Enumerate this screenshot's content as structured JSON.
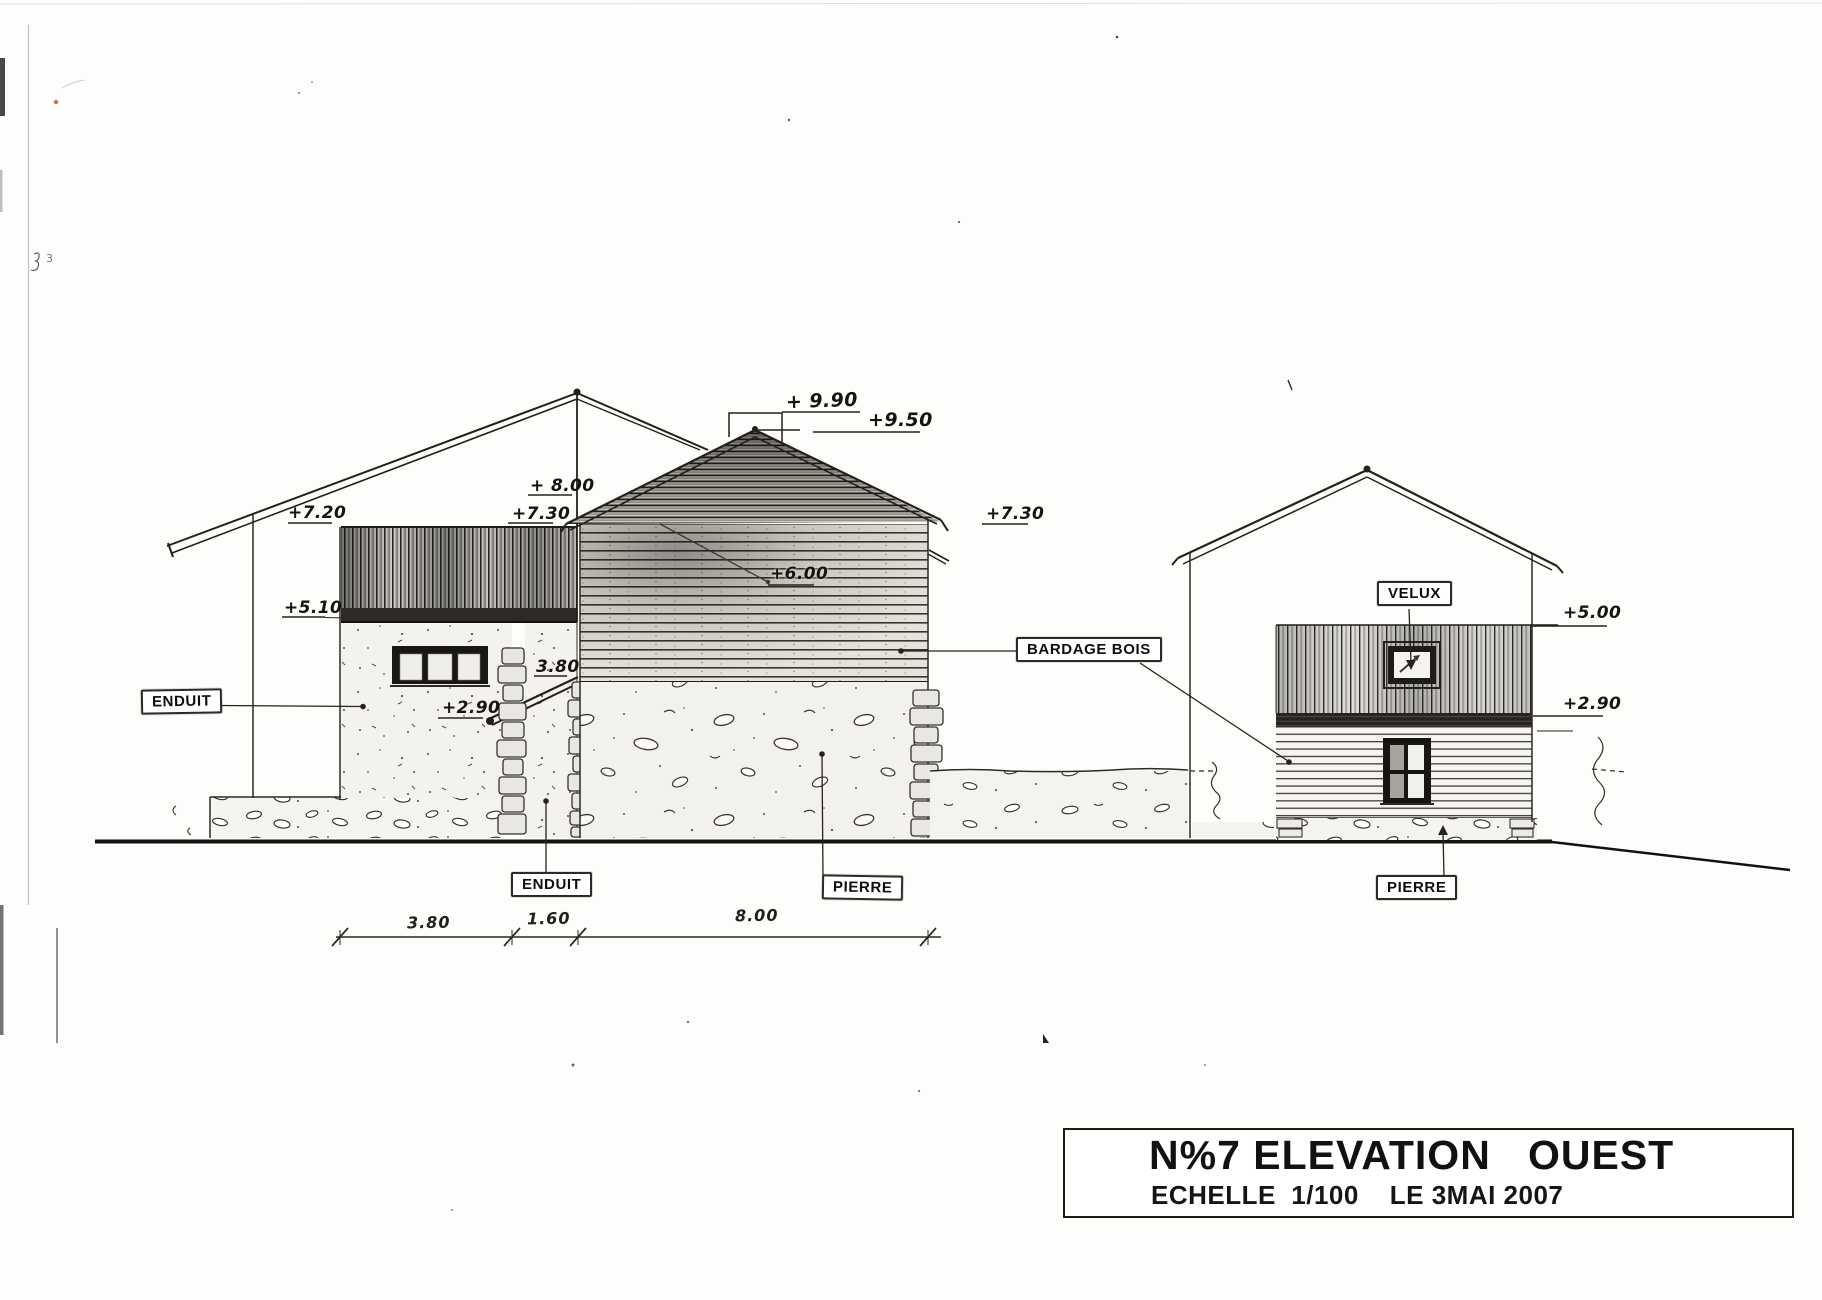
{
  "drawing": {
    "material_labels": {
      "enduit_left": "ENDUIT",
      "enduit_bottom": "ENDUIT",
      "pierre_center": "PIERRE",
      "pierre_right": "PIERRE",
      "bardage_bois": "BARDAGE  BOIS",
      "velux": "VELUX"
    },
    "elevation_marks": {
      "left_eave": "+7.20",
      "center_eave": "+ 8.00",
      "center_left_730": "+7.30",
      "left_band_bottom": "+5.10",
      "ridge_cap": "+ 9.90",
      "ridge_secondary": "+9.50",
      "rear_eave": "+6.00",
      "center_right_730": "+7.30",
      "awning_top": "3.80",
      "awning_base": "+2.90",
      "right_band_top": "+5.00",
      "right_band_bottom": "+2.90"
    },
    "dimension_line": {
      "segments": [
        "3.80",
        "1.60",
        "8.00"
      ]
    },
    "title_block": {
      "title": "N%7 ELEVATION   OUEST",
      "subtitle": "ECHELLE  1/100    LE 3MAI 2007"
    },
    "artifacts": {
      "margin_mark": "3"
    }
  }
}
